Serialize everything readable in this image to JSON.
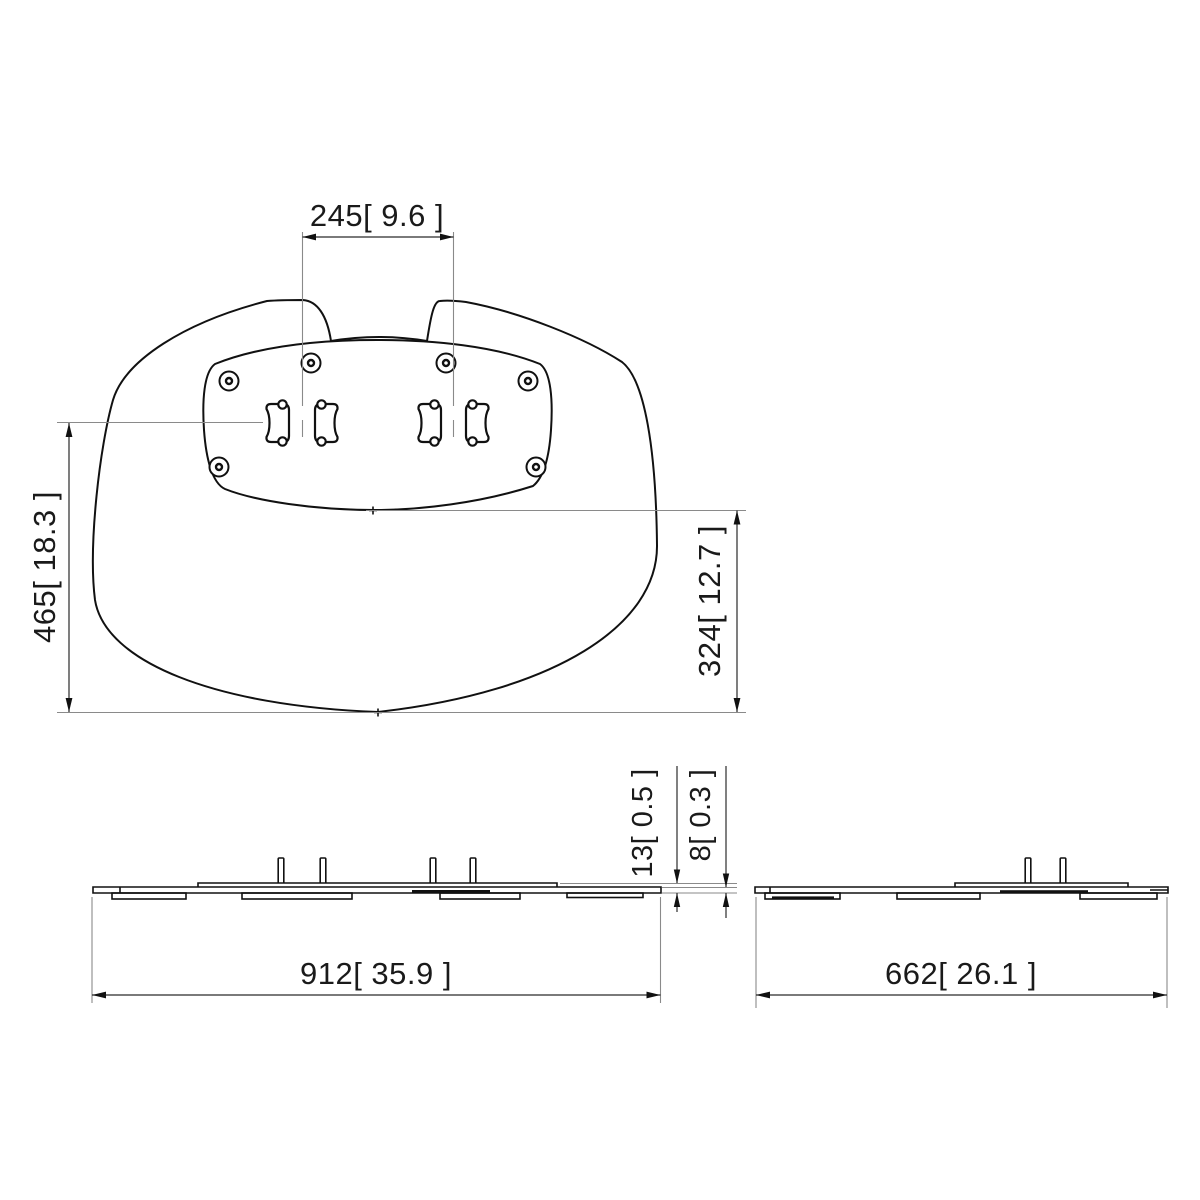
{
  "colors": {
    "background": "#ffffff",
    "geometry_line": "#111111",
    "dimension_line": "#2a2a2a",
    "extension_line": "#8a8a8a",
    "dimension_text": "#1a1a1a"
  },
  "views": {
    "top": {
      "dims": {
        "spacing": "245[ 9.6 ]",
        "overall_depth": "465[ 18.3 ]",
        "plate_depth": "324[ 12.7 ]"
      }
    },
    "front": {
      "dims": {
        "width": "912[ 35.9 ]",
        "thickness_overall": "13[ 0.5 ]",
        "thickness_plate": "8[ 0.3 ]"
      }
    },
    "side": {
      "dims": {
        "depth": "662[ 26.1 ]"
      }
    }
  }
}
